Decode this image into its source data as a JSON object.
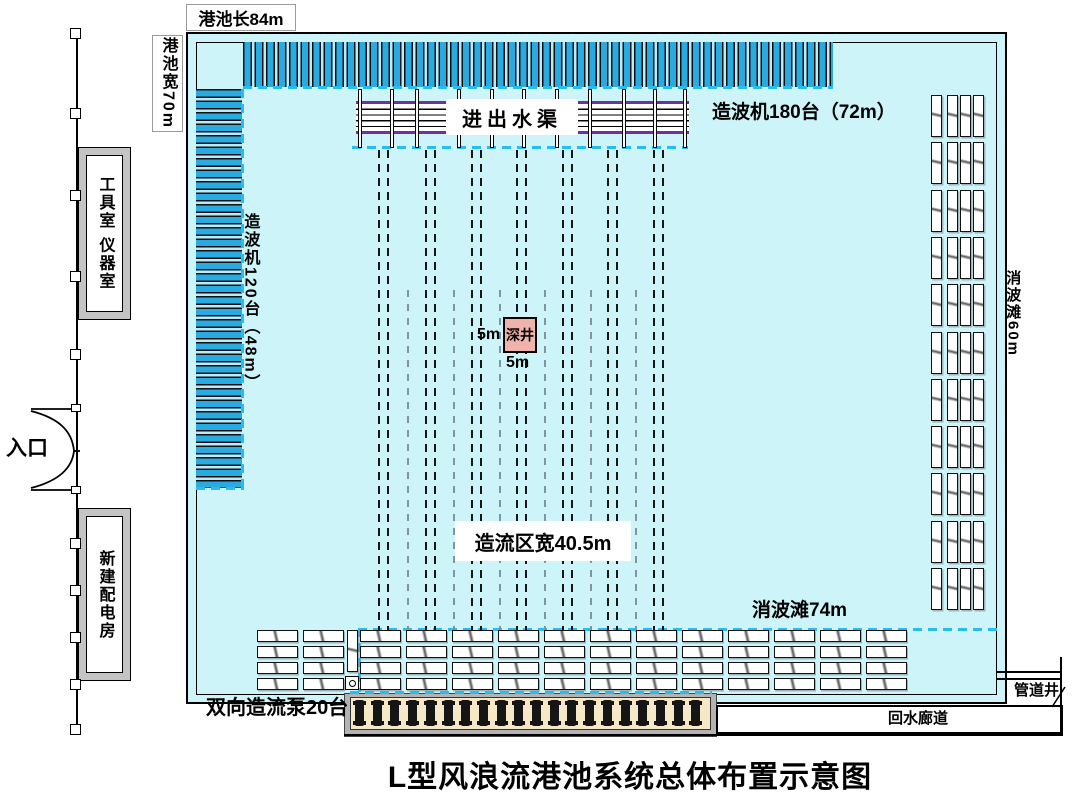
{
  "diagram": {
    "title": "L型风浪流港池系统总体布置示意图",
    "basin_length_label": "港池长84m",
    "basin_width_label": "港池宽70m",
    "tool_room_label": "工具室 仪器室",
    "entrance_label": "入口",
    "power_room_label": "新建配电房",
    "inlet_channel_label": "进出水渠",
    "top_wavemaker_label": "造波机180台（72m）",
    "left_wavemaker_label": "造波机120台（48m）",
    "deep_well_label": "深井",
    "deep_well_width_label": "5m",
    "deep_well_height_label": "5m",
    "flow_zone_label": "造流区宽40.5m",
    "right_absorber_label": "消波滩60m",
    "bottom_absorber_label": "消波滩74m",
    "pump_label": "双向造流泵20台",
    "pipe_shaft_label": "管道井",
    "return_corridor_label": "回水廊道"
  },
  "colors": {
    "water": "#cdf4f8",
    "wavemaker_blue": "#29abe2",
    "dashed_cyan": "#27bdf0",
    "channel_purple": "#7030a0",
    "deep_well_pink": "#efb3ab",
    "pump_bed_beige": "#f6e8c6",
    "building_gray": "#c4c4c4"
  },
  "decor": {
    "flow_guide_pair_x": [
      383,
      430,
      476,
      521,
      567,
      612,
      658
    ],
    "flow_guide_single_x": [
      407,
      453,
      499,
      544,
      590,
      635
    ],
    "channel_post_x": [
      358,
      390,
      415,
      457,
      490,
      522,
      555,
      588,
      622,
      653,
      683
    ],
    "fence_post_y": [
      28,
      108,
      190,
      271,
      349,
      538,
      585,
      632,
      679,
      724
    ],
    "door_hinge_y": [
      404,
      486
    ],
    "right_absorber_rows": 11,
    "right_absorber_slats_per_row": 4,
    "bottom_absorber_col_x": [
      257,
      303,
      360,
      406,
      452,
      498,
      544,
      590,
      636,
      682,
      728,
      774,
      820,
      866
    ],
    "bottom_absorber_rows": 4,
    "pump_count": 20
  }
}
